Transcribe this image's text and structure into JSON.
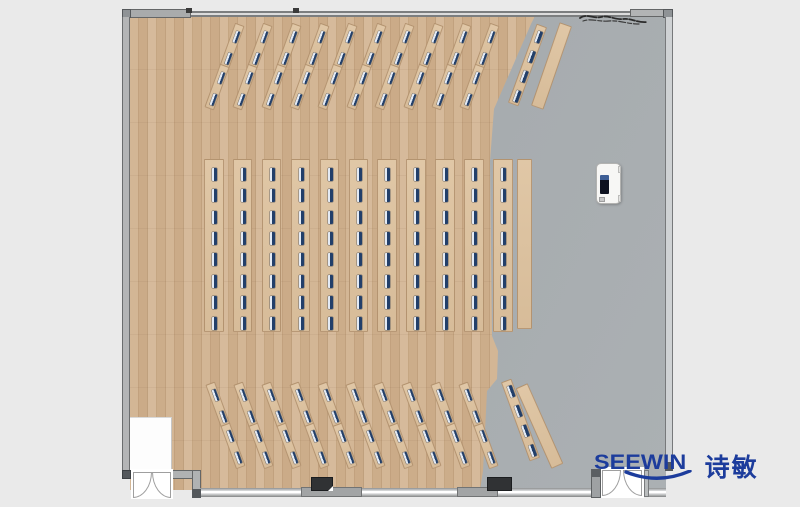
{
  "brand": {
    "name": "SEEWIN",
    "cn": "诗敏",
    "color": "#1c3c9c"
  },
  "palette": {
    "canvas_bg": "#eaeaea",
    "wood_floor_mid": "#cdb091",
    "gray_floor": "#a9aeb1",
    "desk_top": "#ddc3a1",
    "chair_mark": "#223f6a",
    "chair_highlight": "#e3eaf4",
    "wall_fill": "#b2b4b5",
    "wall_line": "#646667",
    "window_glass": "#ffffff",
    "structure_block": "#303234",
    "podium_body": "#f7f7f5",
    "podium_screen": "#0e1220"
  },
  "floorplan": {
    "canvas": {
      "w": 800,
      "h": 507
    },
    "room": {
      "x": 122,
      "y": 9,
      "w": 551,
      "h": 489
    },
    "seat_total": 176,
    "seat_counts": {
      "top_fan": 44,
      "middle_block": 88,
      "bottom_fan": 44
    },
    "top_group": {
      "angle": 20,
      "columns": 10,
      "mid_x0": 224,
      "col_dx": 28.4,
      "mid_y": 66,
      "row_dy": 20.5,
      "row_shift": 7.5,
      "strip_l": 46,
      "strip_w": 9.5,
      "seats_per_strip": 2
    },
    "middle_group": {
      "columns": 11,
      "x0": 204,
      "col_dx": 28.9,
      "y": 159,
      "w": 19.5,
      "h": 173,
      "seats": 8,
      "seat_y0": 8,
      "seat_dy": 21.3
    },
    "bottom_group": {
      "angle": -20,
      "columns": 10,
      "mid_x0": 225,
      "col_dx": 28.1,
      "mid_y": 425,
      "row_dy": 20.5,
      "row_shift": -7.5,
      "strip_l": 46,
      "strip_w": 9.5,
      "seats_per_strip": 2
    },
    "long_desks": [
      {
        "cx": 527,
        "cy": 65,
        "angle": 20,
        "l": 84,
        "w": 11,
        "seats": 4
      },
      {
        "cx": 520,
        "cy": 420,
        "angle": -20,
        "l": 84,
        "w": 11,
        "seats": 4
      }
    ],
    "counters": [
      {
        "cx": 551,
        "cy": 66,
        "angle": 19,
        "l": 88,
        "w": 13
      },
      {
        "cx": 539,
        "cy": 426,
        "angle": -24,
        "l": 88,
        "w": 13
      },
      {
        "cx": 524.5,
        "cy": 243.5,
        "angle": 0,
        "l": 170,
        "w": 15
      }
    ],
    "podium": {
      "x": 596,
      "y": 163,
      "w": 25,
      "h": 41
    },
    "doors": [
      {
        "id": "door-bottom-left",
        "x": 133,
        "y": 472,
        "leaves": 2
      },
      {
        "id": "door-bottom-right",
        "x": 601,
        "y": 470,
        "leaves": 2
      }
    ],
    "structure_blocks": [
      {
        "x": 311,
        "y": 477,
        "w": 22,
        "h": 14
      },
      {
        "x": 487,
        "y": 477,
        "w": 25,
        "h": 14
      }
    ],
    "annotations": [
      {
        "type": "scribble",
        "x": 577,
        "y": 10
      }
    ]
  }
}
